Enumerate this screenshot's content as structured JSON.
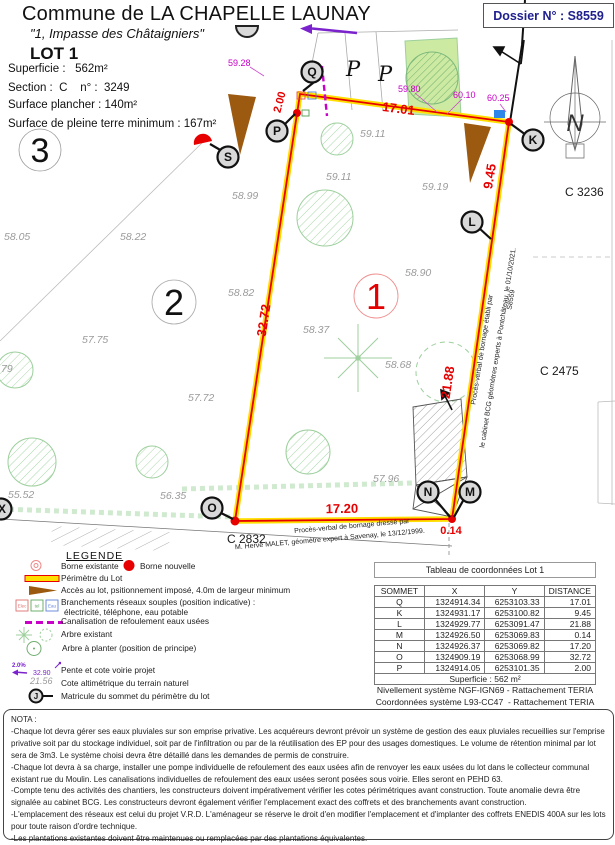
{
  "header": {
    "commune": "Commune de LA CHAPELLE LAUNAY",
    "address": "\"1, Impasse des Châtaigniers\"",
    "lot": "LOT 1",
    "line_superficie": "Superficie :   562m²",
    "line_section": "Section :  C    n° :  3249",
    "line_plancher": "Surface plancher : 140m²",
    "line_terre": "Surface de pleine terre minimum : 167m²",
    "dossier": "Dossier N° : S8559"
  },
  "plan": {
    "lots": {
      "n1": "1",
      "n2": "2",
      "n3": "3"
    },
    "parcels": {
      "c2832": "C 2832",
      "c3236": "C 3236",
      "c2475": "C 2475"
    },
    "vertices": {
      "q": "Q",
      "k": "K",
      "l": "L",
      "m": "M",
      "n": "N",
      "o": "O",
      "p": "P",
      "s": "S",
      "x": "X"
    },
    "dims": {
      "pq": "2.00",
      "qk": "17.01",
      "kl": "9.45",
      "lm": "21.88",
      "mn": "0.14",
      "no": "17.20",
      "op": "32.72"
    },
    "proj_levels": {
      "v1": "59.28",
      "v2": "59.80",
      "v3": "60.10",
      "v4": "60.25"
    },
    "cotes": [
      "58.05",
      "58.22",
      "58.99",
      "58.82",
      "57.75",
      "59.11",
      "59.11",
      "59.19",
      "58.90",
      "58.37",
      "58.68",
      "57.96",
      "57.72",
      "55.52",
      "56.35",
      "79"
    ],
    "parking": "P",
    "north": "N",
    "annot_right1": "Procès-verbal de bornage établi par",
    "annot_right2": "le cabinet BCG géomètres experts à Pontchâteau, le 01/10/2021.",
    "annot_right3": "S8559",
    "annot_bottom1": "Procès-verbal de bornage dressé par",
    "annot_bottom2": "M. Hervé MALET, géomètre expert à Savenay, le 13/12/1999."
  },
  "legend": {
    "title": "LEGENDE",
    "borne_existante": "Borne existante",
    "borne_nouvelle": "Borne nouvelle",
    "perimetre": "Périmètre du Lot",
    "acces": "Accès au lot, psitionnement imposé, 4.0m de largeur minimum",
    "branchements1": "Branchements réseaux souples (position indicative) :",
    "branchements2": "électricité, téléphone, eau potable",
    "box_elec": "Elec",
    "box_tel": "tel",
    "box_eau": "Eau",
    "canalisation": "Canalisation de refoulement eaux usées",
    "arbre_existant": "Arbre existant",
    "arbre_planter": "Arbre à planter (position de principe)",
    "pente": "Pente et cote voirie projet",
    "pente_pct": "2.0%",
    "pente_cote": "32.90",
    "cote_alti": "Cote altimétrique du terrain naturel",
    "cote_sample": "21.56",
    "matricule": "Matricule du sommet du périmètre du lot",
    "matricule_letter": "J"
  },
  "table": {
    "title": "Tableau de coordonnées Lot 1",
    "headers": [
      "SOMMET",
      "X",
      "Y",
      "DISTANCE"
    ],
    "rows": [
      {
        "s": "Q",
        "x": "1324914.34",
        "y": "6253103.33",
        "d": "17.01"
      },
      {
        "s": "K",
        "x": "1324931.17",
        "y": "6253100.82",
        "d": "9.45"
      },
      {
        "s": "L",
        "x": "1324929.77",
        "y": "6253091.47",
        "d": "21.88"
      },
      {
        "s": "M",
        "x": "1324926.50",
        "y": "6253069.83",
        "d": "0.14"
      },
      {
        "s": "N",
        "x": "1324926.37",
        "y": "6253069.82",
        "d": "17.20"
      },
      {
        "s": "O",
        "x": "1324909.19",
        "y": "6253068.99",
        "d": "32.72"
      },
      {
        "s": "P",
        "x": "1324914.05",
        "y": "6253101.35",
        "d": "2.00"
      }
    ],
    "footer": "Superficie : 562 m²",
    "ref1": "Nivellement système NGF-IGN69 - Rattachement TERIA",
    "ref2": "Coordonnées système L93-CC47  - Rattachement TERIA"
  },
  "nota": {
    "title": "NOTA :",
    "items": [
      "-Chaque lot devra gérer ses eaux pluviales sur son emprise privative. Les acquéreurs devront prévoir un système de gestion des eaux pluviales recueillies sur l'emprise privative soit par du stockage individuel, soit par de l'infiltration ou par de la réutilisation des EP pour des usages domestiques. Le volume de rétention minimal par lot sera de 3m3. Le système choisi devra être détaillé dans les demandes de permis de construire.",
      "-Chaque lot devra à sa charge, installer une pompe individuelle de refoulement des eaux usées afin de renvoyer les eaux usées du lot dans le collecteur communal existant rue du Moulin. Les canalisations individuelles de refoulement des eaux usées seront posées sous voirie. Elles seront en PEHD 63.",
      "-Compte tenu des activités des chantiers, les constructeurs doivent impérativement vérifier les cotes périmétriques avant construction. Toute anomalie devra être signalée au cabinet BCG. Les constructeurs devront également vérifier l'emplacement exact des coffrets et des branchements avant construction.",
      "-L'emplacement des réseaux est celui du projet V.R.D. L'aménageur se réserve le droit d'en modifier l'emplacement et d'implanter des coffrets ENEDIS 400A sur les lots pour toute raison d'ordre technique.",
      "-Les plantations existantes doivent être maintenues ou remplacées par des plantations équivalentes."
    ]
  },
  "colors": {
    "boundary_red": "#e60000",
    "boundary_yellow": "#ffdf00",
    "magenta": "#c800c8",
    "cote_gray": "#9b9b9b",
    "brown": "#9c5a10",
    "navy": "#20208f",
    "purple": "#7a22cc",
    "green": "#9ccf9c",
    "blue_box": "#2e86e8"
  }
}
